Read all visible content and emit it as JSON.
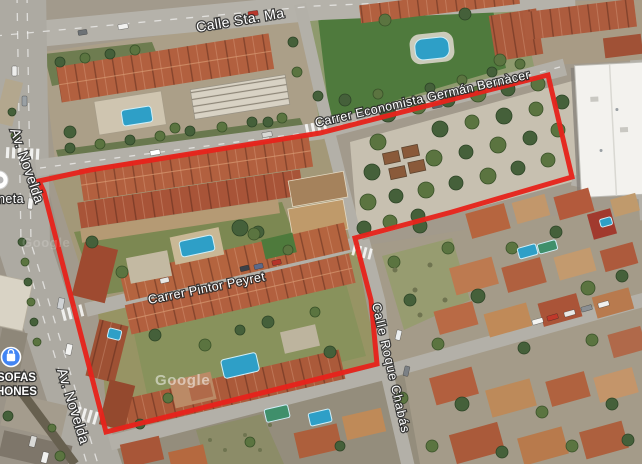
{
  "map": {
    "view": "satellite",
    "watermark": "Google",
    "watermark_faint": "Google",
    "streets": {
      "calle_sta_ma": "Calle Sta. Ma",
      "economista": "Carrer Economista Germán Bernàcer",
      "av_novelda_upper": "Av. Novelda",
      "av_novelda_lower": "Av. Novelda",
      "pintor_peyret": "Carrer Pintor Peyret",
      "roque_chabas": "Calle Roque Chabás"
    },
    "pois": {
      "partial_name": "neta",
      "store_line1": "SOFAS",
      "store_line2": "HONES",
      "store_icon": "shopping-bag-icon"
    },
    "boundary": {
      "color": "#e6231c",
      "points": "39,181 90,170 320,133 548,75 572,177 452,212 355,238 371,300 377,364 106,432 44,192"
    },
    "colors": {
      "boundary_red": "#e6231c",
      "poi_blue": "#4285f4",
      "pool_blue": "#2e9fc7",
      "pool_green": "#3f8f6b",
      "roof_terracotta": "#b2603f",
      "road_gray": "#b2afa8",
      "vegetation_green": "#55713f",
      "plaza_pavement": "#c7c0b0",
      "warehouse_white": "#f3f2ee"
    }
  }
}
